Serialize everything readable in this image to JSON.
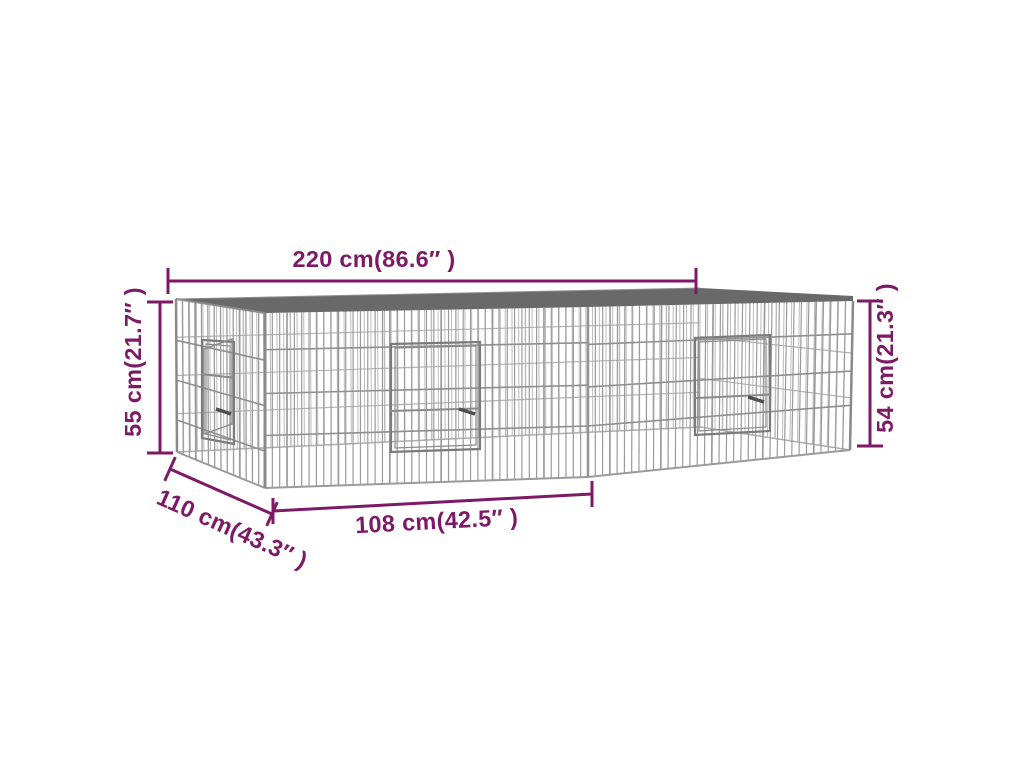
{
  "figure": {
    "type": "product-dimension-diagram",
    "subject": "galvanized wire mesh pet enclosure shown in 3D perspective",
    "background_color": "#ffffff",
    "colors": {
      "dimension": "#7d1a66",
      "roof": "#696969",
      "roof_highlight": "#909090",
      "wire": "#9b9b9b",
      "wire_light": "#bcbcbc",
      "rail": "#8f8f8f",
      "rail_light": "#b3b3b3",
      "edge": "#8a8a8a",
      "interior_edge": "#adadad",
      "door_frame": "#7b7b7b",
      "door_inner": "#8a8a8a",
      "latch": "#4f4f4f"
    },
    "dimensions": {
      "width": "220 cm(86.6″ )",
      "height_left": "55 cm(21.7″ )",
      "height_right": "54 cm(21.3″ )",
      "depth": "110 cm(43.3″ )",
      "panel_width": "108 cm(42.5″ )"
    },
    "doors_visible": 3
  }
}
